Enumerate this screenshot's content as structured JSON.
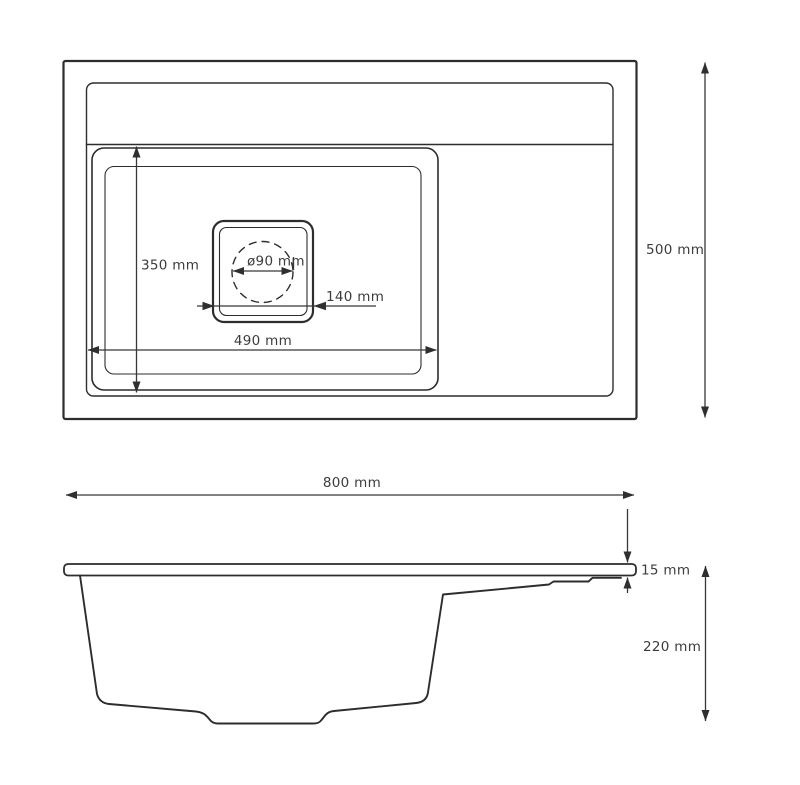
{
  "drawing": {
    "subject": "kitchen sink technical dimension drawing",
    "top_view": {
      "labels": {
        "bowl_depth": "350 mm",
        "drain_diameter": "ø90 mm",
        "drain_width": "140 mm",
        "bowl_width": "490 mm",
        "overall_depth": "500 mm"
      }
    },
    "side_view": {
      "labels": {
        "overall_width": "800 mm",
        "rim_thickness": "15 mm",
        "overall_height": "220 mm"
      }
    },
    "colors": {
      "outline": "#2d2d2d",
      "dimension_line": "#383838",
      "text": "#3c3c3c",
      "background": "#ffffff"
    }
  }
}
